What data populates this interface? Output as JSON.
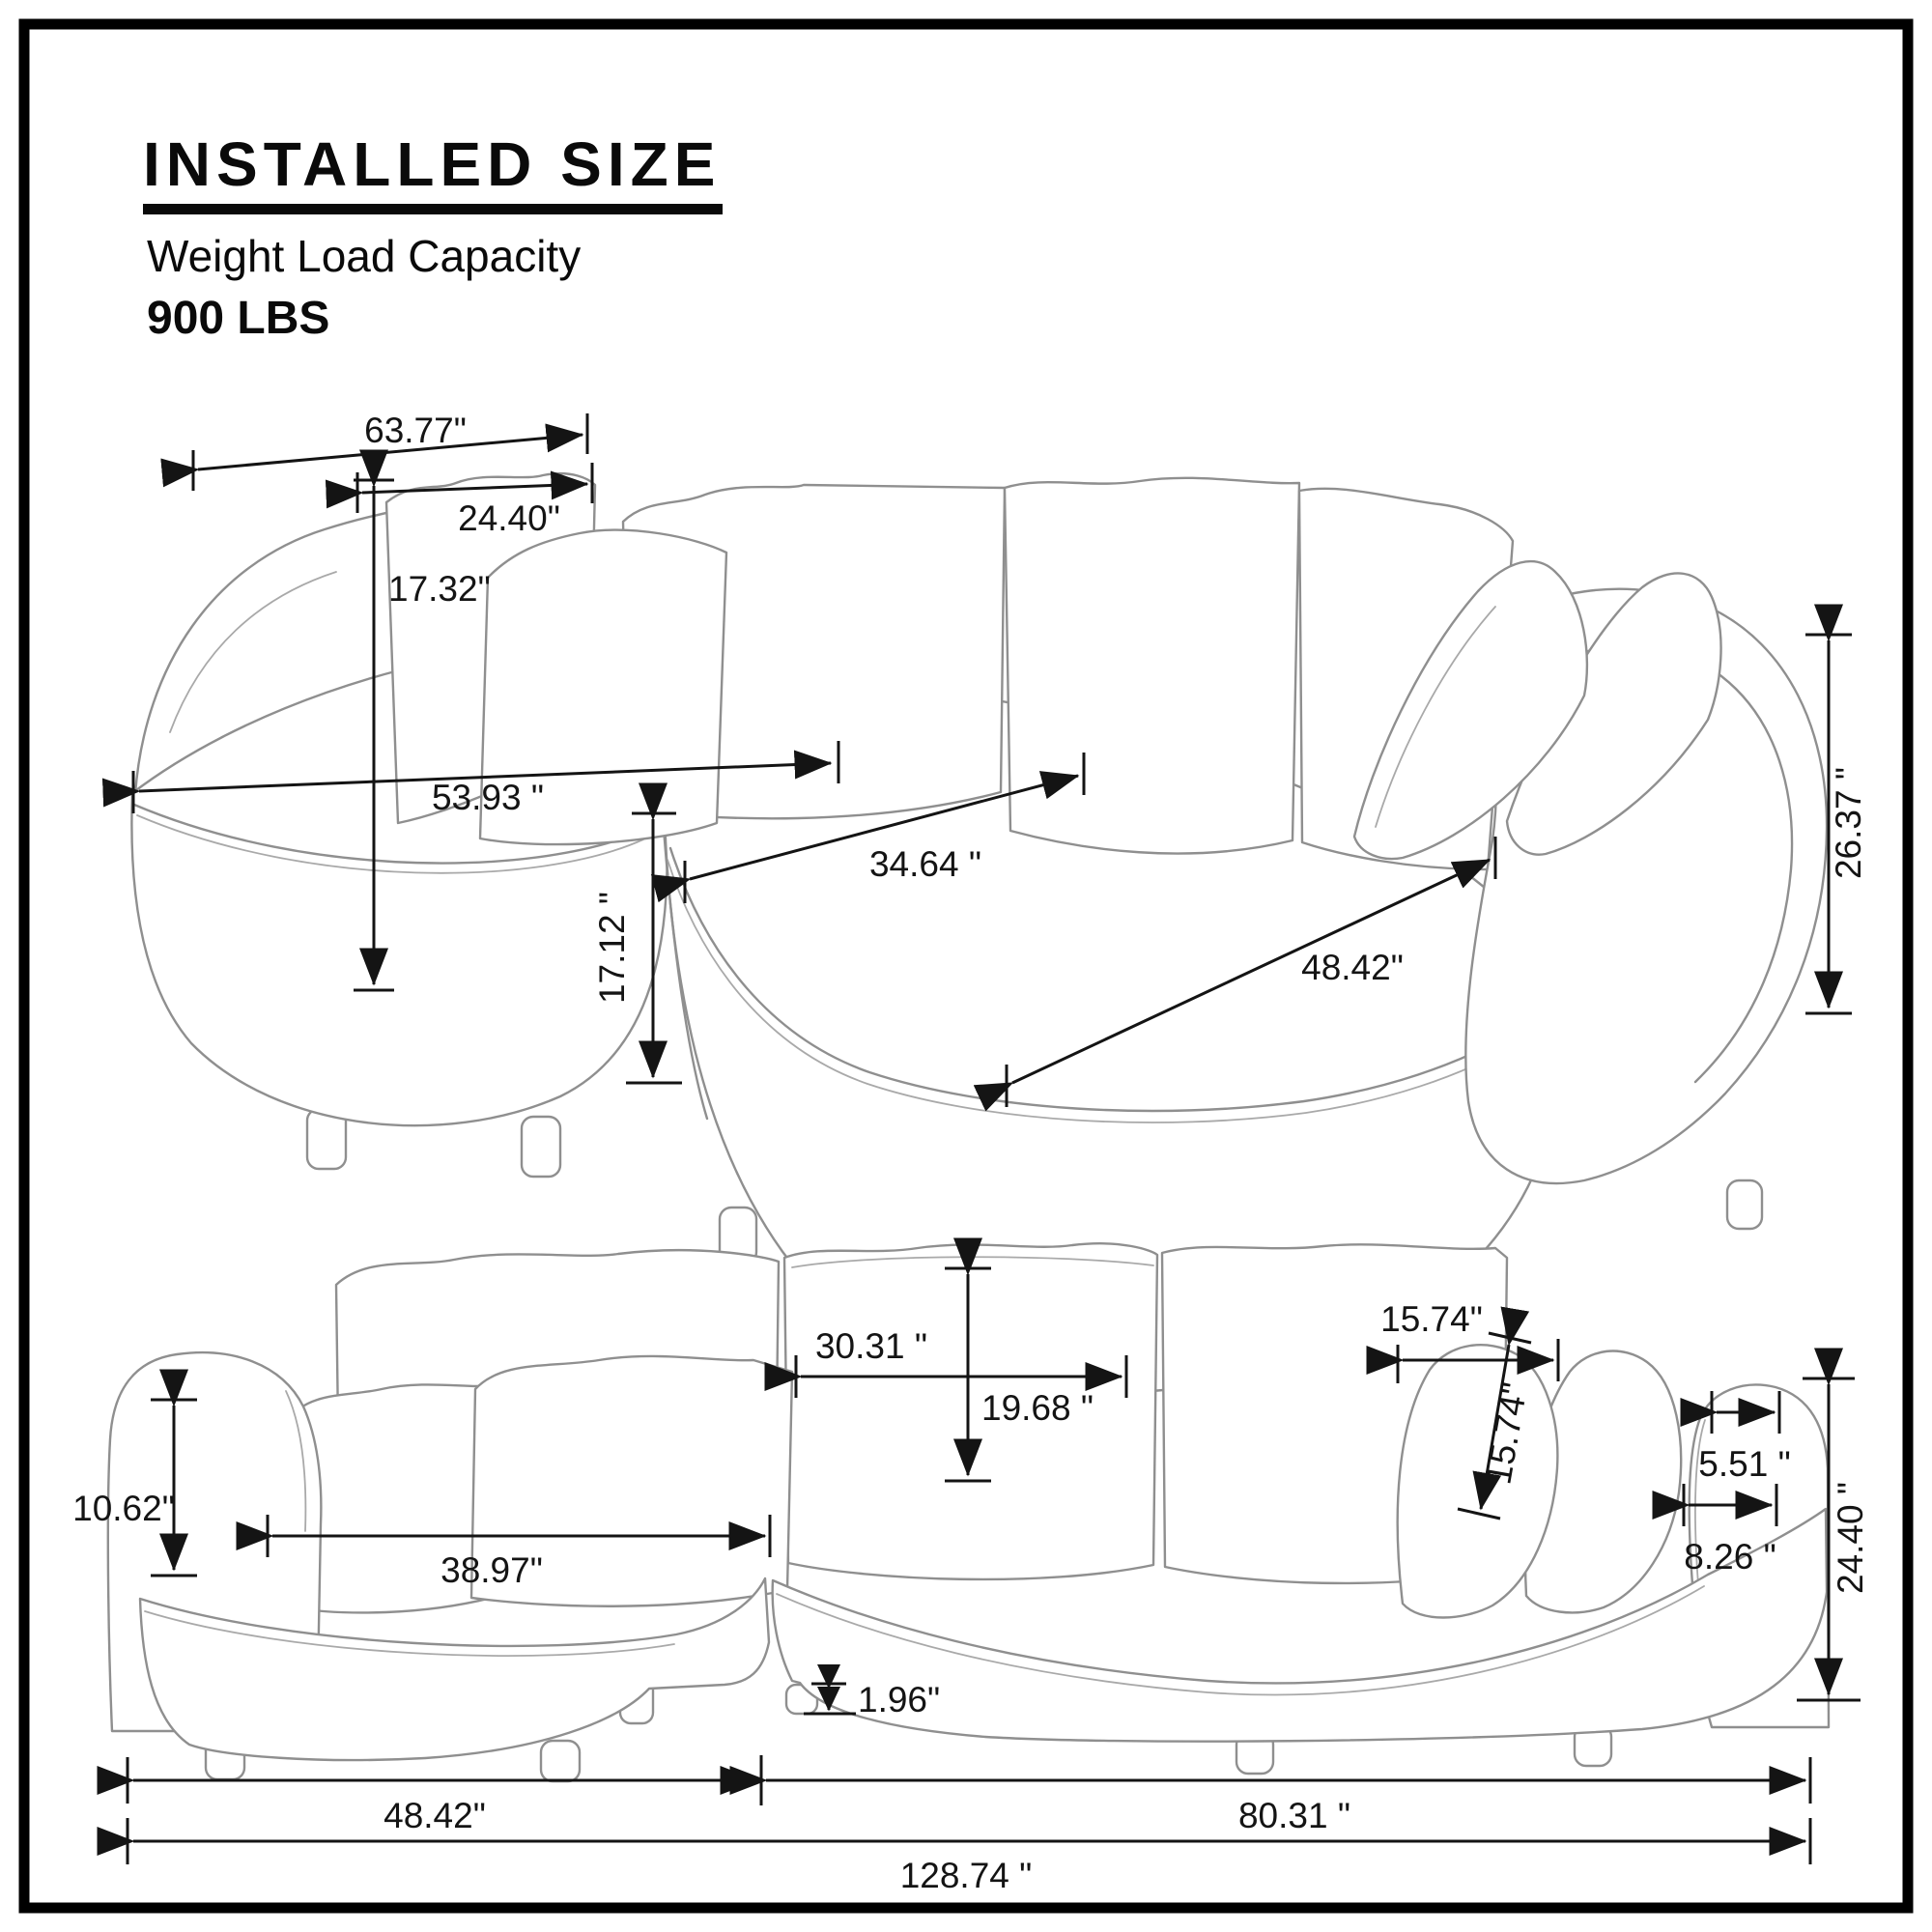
{
  "header": {
    "title": "INSTALLED SIZE",
    "subtitle": "Weight Load Capacity",
    "capacity": "900 LBS"
  },
  "top_view": {
    "dims": {
      "back_width": "63.77\"",
      "back_pillow_width": "24.40\"",
      "back_pillow_height": "17.32\"",
      "chaise_seat_diag": "53.93 \"",
      "mid_seat_width": "34.64 \"",
      "right_seat_diag": "48.42\"",
      "seat_height": "17.12 \"",
      "back_height": "26.37 \""
    }
  },
  "front_view": {
    "dims": {
      "arm_height": "10.62\"",
      "chaise_seat_width": "38.97\"",
      "back_pillow_width": "30.31 \"",
      "back_pillow_height": "19.68 \"",
      "small_pillow_width": "15.74\"",
      "small_pillow_height": "15.74\"",
      "arm_top_depth": "5.51 \"",
      "arm_base_depth": "8.26 \"",
      "overall_height": "24.40 \"",
      "leg_height": "1.96\"",
      "chaise_width": "48.42\"",
      "right_section_width": "80.31 \"",
      "total_width": "128.74 \""
    }
  }
}
